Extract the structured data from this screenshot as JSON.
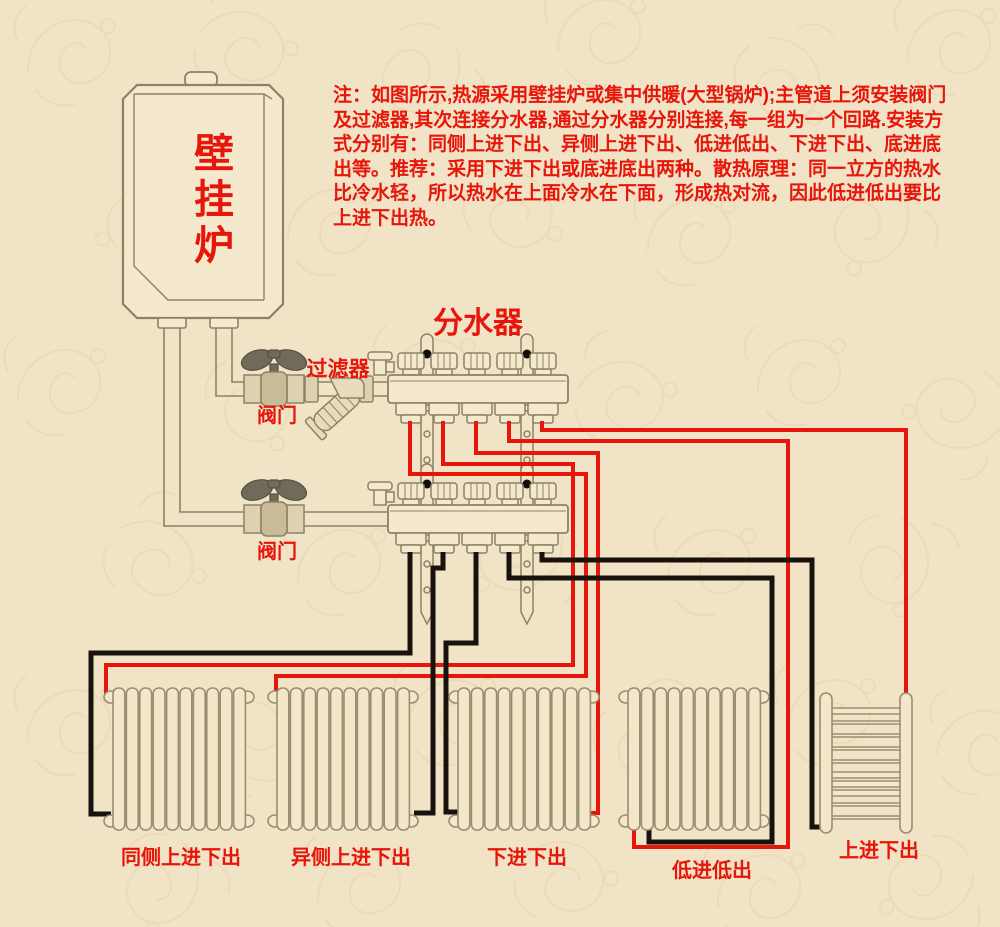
{
  "note": {
    "lines": [
      "注：如图所示,热源采用壁挂炉或集中供暖(大型锅炉);主管道上须安装阀门",
      "及过滤器,其次连接分水器,通过分水器分别连接,每一组为一个回路.安装方",
      "式分别有：同侧上进下出、异侧上进下出、低进低出、下进下出、底进底",
      "出等。推荐：采用下进下出或底进底出两种。散热原理：同一立方的热水",
      "比冷水轻，所以热水在上面冷水在下面，形成热对流，因此低进低出要比",
      "上进下出热。"
    ]
  },
  "labels": {
    "boiler": "壁挂炉",
    "manifold": "分水器",
    "filter": "过滤器",
    "valve_top": "阀门",
    "valve_bottom": "阀门",
    "radiator_1": "同侧上进下出",
    "radiator_2": "异侧上进下出",
    "radiator_3": "下进下出",
    "radiator_4": "低进低出",
    "radiator_5": "上进下出"
  },
  "colors": {
    "supply_pipe": "#e8150a",
    "return_pipe": "#17120d",
    "label_text": "#e8150a",
    "background": "#f1e3c6",
    "pattern": "#e7d4ad",
    "equipment_outline": "#8e8266",
    "equipment_fill": "#f5e9cd",
    "dark_metal": "#6f6a5a"
  }
}
